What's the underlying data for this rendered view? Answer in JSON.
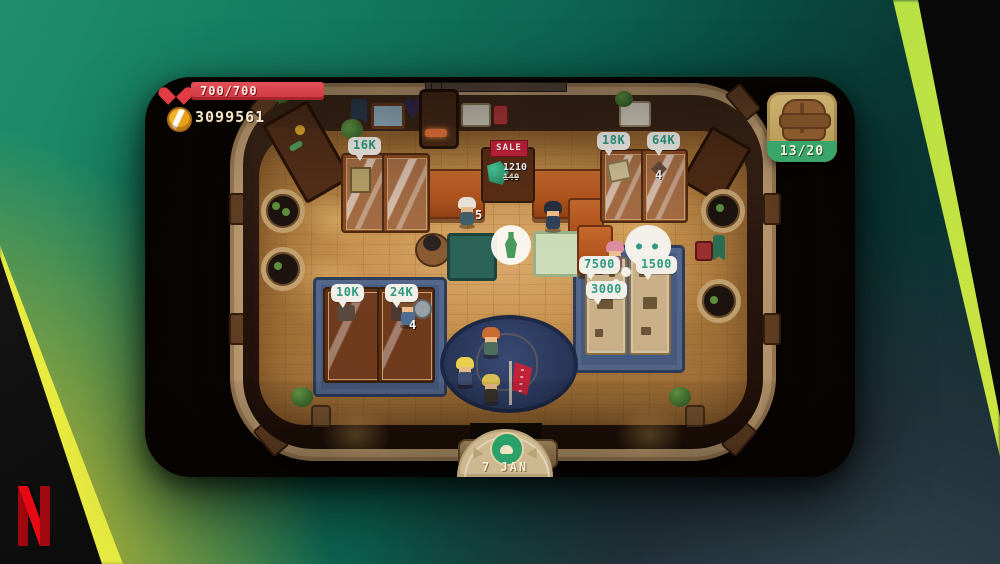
{
  "brand": {
    "name_hint": "netflix-logo"
  },
  "hud": {
    "health": {
      "value": "700/700",
      "bar_color": "#cf3740"
    },
    "coins": {
      "value": "3099561",
      "coin_color": "#e8a01c"
    },
    "inventory": {
      "value": "13/20",
      "badge_color": "#3aa569"
    },
    "date": {
      "value": "7 JAN"
    }
  },
  "shop": {
    "sale_sign": "SALE",
    "sale_price_new": "1210",
    "sale_price_old": "140",
    "thought_dots": "● ●",
    "bubbles": {
      "b16k": "16K",
      "b18k": "18K",
      "b64k": "64K",
      "b10k": "10K",
      "b24k": "24K",
      "b7500": "7500",
      "b1500": "1500",
      "b3000": "3000"
    },
    "counts": {
      "case_64k": "4",
      "case_24k": "4",
      "carried": "5"
    }
  },
  "colors": {
    "bubble_text": "#2f9a82",
    "netflix_red": "#e50914",
    "bg_green": "#1f8f6c",
    "bg_lime_edge": "#dbe63e",
    "bg_slate": "#33464e"
  }
}
